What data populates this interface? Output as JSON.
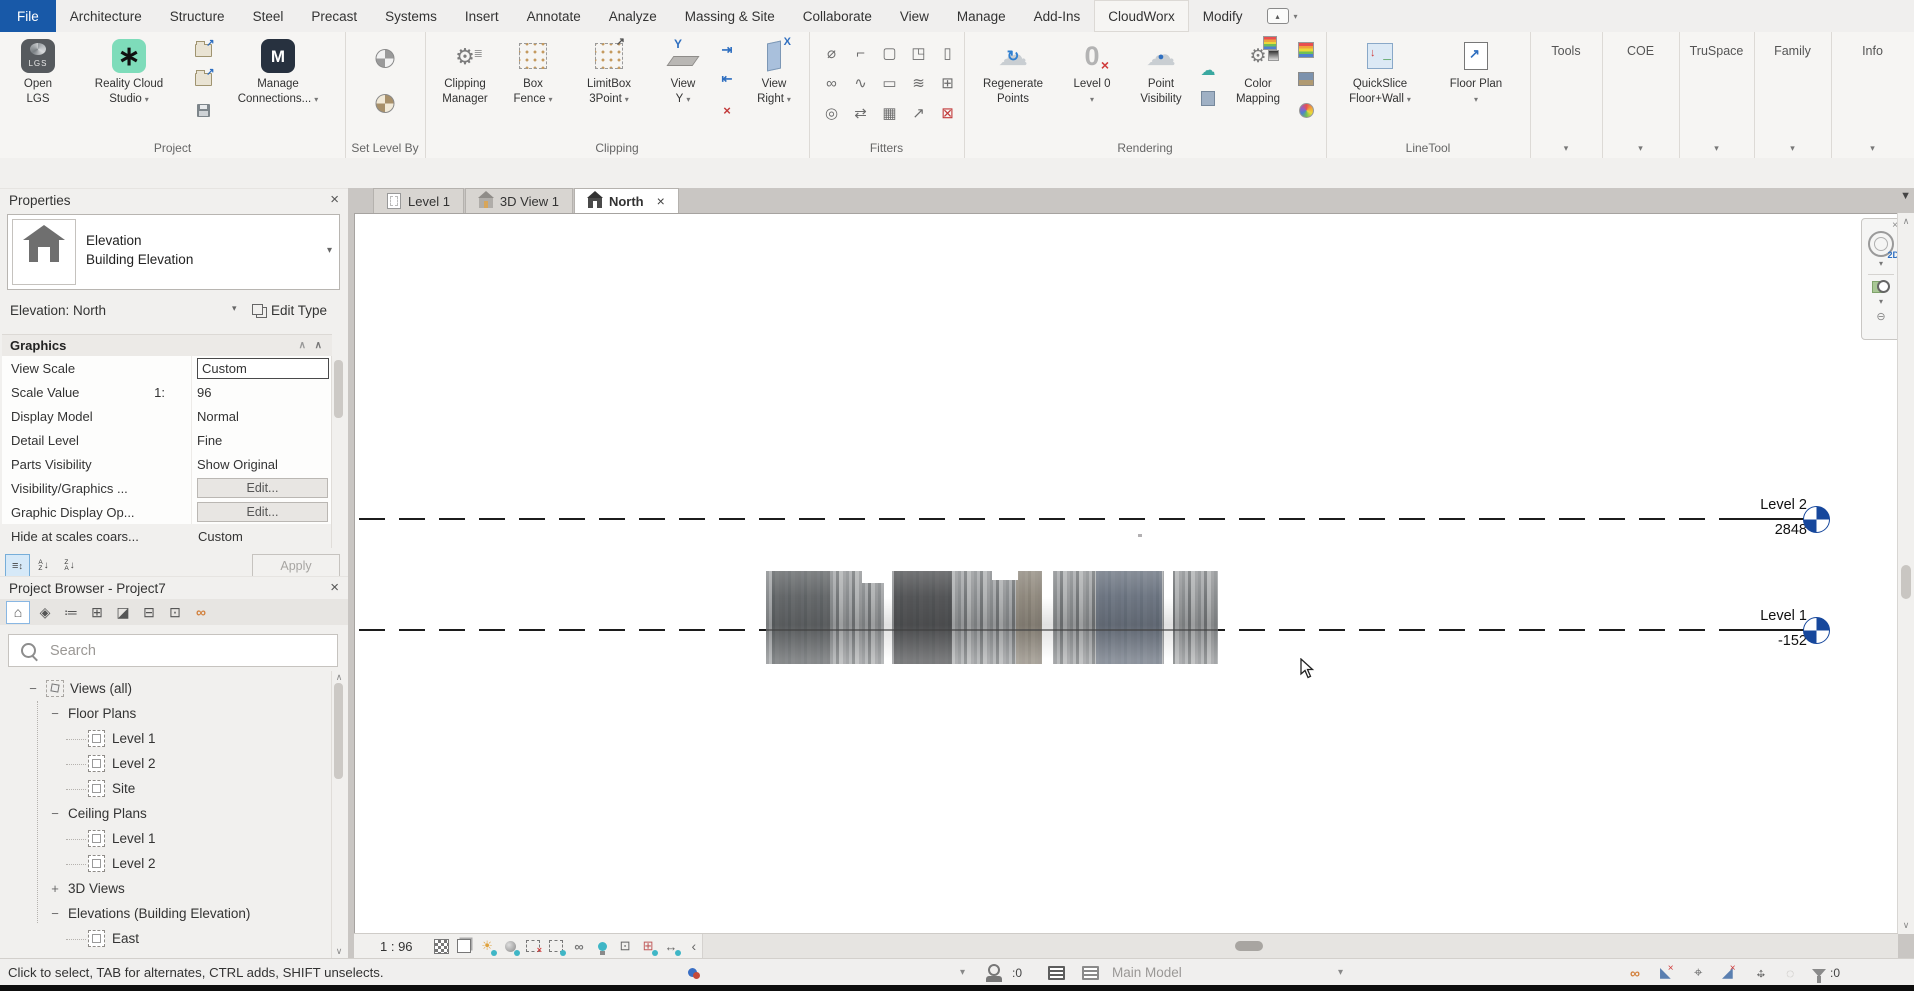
{
  "menu": {
    "tabs": [
      "File",
      "Architecture",
      "Structure",
      "Steel",
      "Precast",
      "Systems",
      "Insert",
      "Annotate",
      "Analyze",
      "Massing & Site",
      "Collaborate",
      "View",
      "Manage",
      "Add-Ins",
      "CloudWorx",
      "Modify"
    ]
  },
  "glyphs": {
    "caret": "▾",
    "close": "×",
    "scroll_up": "∧",
    "scroll_down": "∨",
    "scroll_left": "‹",
    "tab_overflow": "▼",
    "gear": "⚙",
    "cloud": "☁",
    "refresh": "↻",
    "sun": "☀",
    "glasses": "∞",
    "circle_dot": "◌",
    "link": "∞",
    "pin": "⌖",
    "underlay": "◣",
    "face": "◢",
    "redx": "×",
    "minus_circle": "⊖",
    "arrow_ne": "↗",
    "arrow_h": "↔",
    "arrow_v": "↕",
    "grid": "⊞",
    "boxdot": "⊡",
    "menu_arrow": "▴"
  },
  "ribbon": {
    "badges": {
      "lgs": "LGS",
      "reality": "∗",
      "m": "M",
      "y": "Y",
      "zero": "0",
      "twod": "2D"
    },
    "buttons": {
      "open_lgs": {
        "l1": "Open",
        "l2": "LGS"
      },
      "reality_cloud": {
        "l1": "Reality Cloud",
        "l2": "Studio"
      },
      "manage_connections": {
        "l1": "Manage",
        "l2": "Connections..."
      },
      "clipping_manager": {
        "l1": "Clipping",
        "l2": "Manager"
      },
      "box_fence": {
        "l1": "Box",
        "l2": "Fence"
      },
      "limitbox_3point": {
        "l1": "LimitBox",
        "l2": "3Point"
      },
      "view_y": {
        "l1": "View",
        "l2": "Y"
      },
      "view_right": {
        "l1": "View",
        "l2": "Right"
      },
      "regenerate_points": {
        "l1": "Regenerate",
        "l2": "Points"
      },
      "level_0": {
        "l1": "Level 0"
      },
      "point_visibility": {
        "l1": "Point",
        "l2": "Visibility"
      },
      "color_mapping": {
        "l1": "Color",
        "l2": "Mapping"
      },
      "quickslice": {
        "l1": "QuickSlice",
        "l2": "Floor+Wall"
      },
      "floor_plan": {
        "l1": "Floor Plan"
      }
    },
    "panels": {
      "project": "Project",
      "set_level_by": "Set Level By",
      "clipping": "Clipping",
      "fitters": "Fitters",
      "rendering": "Rendering",
      "linetool": "LineTool",
      "tools": "Tools",
      "coe": "COE",
      "truspace": "TruSpace",
      "family": "Family",
      "info": "Info"
    },
    "fitters_glyphs": [
      "⌀",
      "⌐",
      "▢",
      "◳",
      "▯",
      "∞",
      "∿",
      "▭",
      "≋",
      "⊞",
      "◎",
      "⇄",
      "▦",
      "↗",
      "⊠"
    ]
  },
  "properties": {
    "title": "Properties",
    "type": {
      "family": "Elevation",
      "type_name": "Building Elevation"
    },
    "instance": "Elevation: North",
    "edit_type": "Edit Type",
    "section": "Graphics",
    "rows": [
      {
        "label": "View Scale",
        "value": "Custom"
      },
      {
        "label": "Scale Value",
        "suffix": "1:",
        "value": "96"
      },
      {
        "label": "Display Model",
        "value": "Normal"
      },
      {
        "label": "Detail Level",
        "value": "Fine"
      },
      {
        "label": "Parts Visibility",
        "value": "Show Original"
      },
      {
        "label": "Visibility/Graphics ...",
        "value": "Edit..."
      },
      {
        "label": "Graphic Display Op...",
        "value": "Edit..."
      },
      {
        "label": "Hide at scales coars...",
        "value": "Custom"
      }
    ],
    "apply": "Apply"
  },
  "browser": {
    "title": "Project Browser - Project7",
    "search_placeholder": "Search",
    "tree": [
      {
        "exp": "−",
        "label": "Views (all)"
      },
      {
        "exp": "−",
        "label": "Floor Plans"
      },
      {
        "label": "Level 1"
      },
      {
        "label": "Level 2"
      },
      {
        "label": "Site"
      },
      {
        "exp": "−",
        "label": "Ceiling Plans"
      },
      {
        "label": "Level 1"
      },
      {
        "label": "Level 2"
      },
      {
        "exp": "+",
        "label": "3D Views"
      },
      {
        "exp": "−",
        "label": "Elevations (Building Elevation)"
      },
      {
        "label": "East"
      }
    ]
  },
  "viewport": {
    "tabs": [
      {
        "label": "Level 1"
      },
      {
        "label": "3D View 1"
      },
      {
        "label": "North"
      }
    ],
    "levels": [
      {
        "name": "Level 2",
        "elevation": "2848"
      },
      {
        "name": "Level 1",
        "elevation": "-152"
      }
    ],
    "scale": "1 : 96"
  },
  "statusbar": {
    "hint": "Click to select, TAB for alternates, CTRL adds, SHIFT unselects.",
    "editable_count": ":0",
    "workset": "Main Model",
    "filter_count": ":0"
  },
  "colors": {
    "accent_blue": "#1859a8",
    "level_head_blue": "#16479c",
    "reality_teal": "#7edcba",
    "selection_teal": "#3fb6c6",
    "link_orange": "#d2803c"
  }
}
